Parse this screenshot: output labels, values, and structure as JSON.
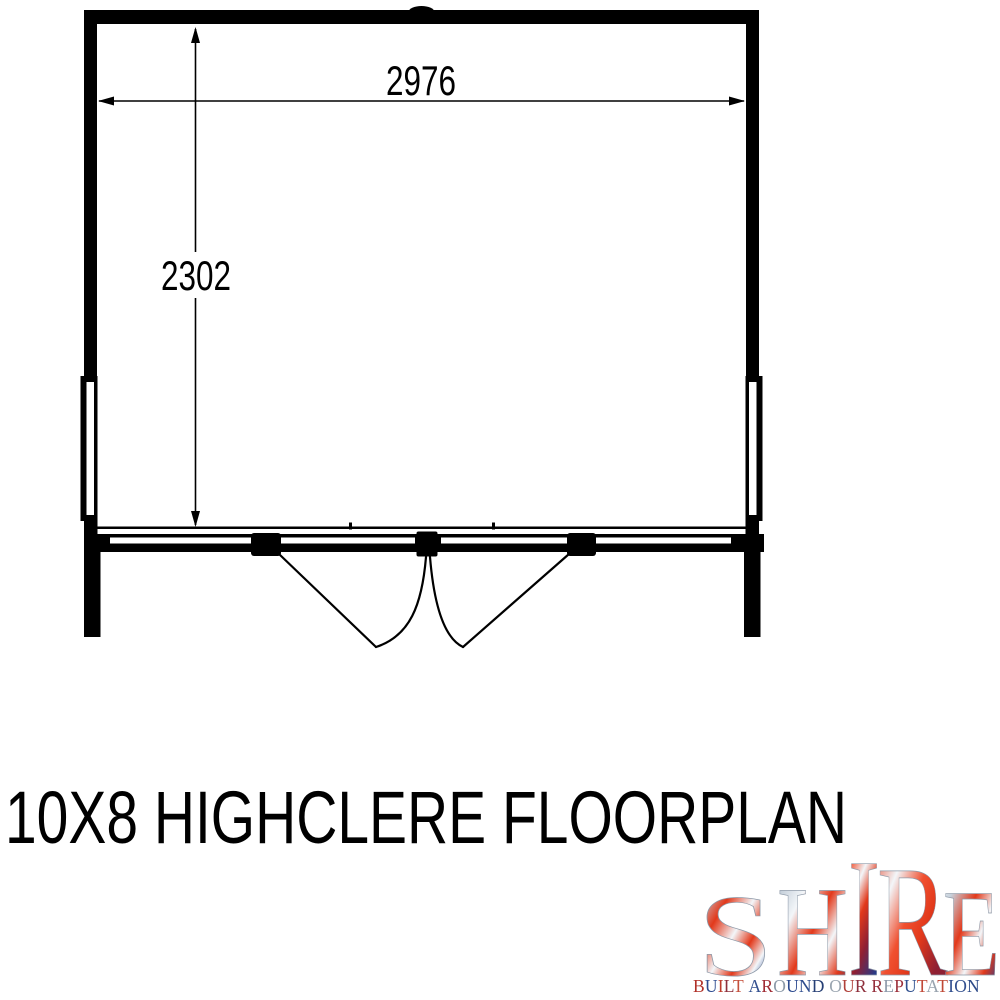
{
  "title": {
    "text": "10X8 HIGHCLERE FLOORPLAN"
  },
  "floorplan": {
    "width_label": "2976",
    "height_label": "2302"
  },
  "logo": {
    "brand": "SHIRE",
    "tagline": "BUILT AROUND OUR REPUTATION",
    "tagline_letter_colors": [
      "#b03028",
      "#2c4a8f",
      "#bd3a2a",
      "#8e2f3b",
      "#c5503c",
      null,
      "#33508f",
      "#a02c35",
      "#8c9aa8",
      "#2c4a8f",
      "#2f4d8e",
      "#263f75",
      null,
      "#9aa5b0",
      "#b0413a",
      "#8e2f3b",
      null,
      "#96303d",
      "#8c99a9",
      "#9c2f3a",
      "#30508f",
      "#c14939",
      "#98a3ae",
      "#bf4936",
      "#2e4c8d",
      "#33508f",
      "#2d4a88"
    ],
    "flag_colors": {
      "red": "#e2391b",
      "orange_red": "#f05030",
      "white": "#f3f6f9",
      "silver": "#c7d1db",
      "navy": "#1d3c8f",
      "maroon": "#8e1f33"
    },
    "drawing_color": "#000000"
  }
}
